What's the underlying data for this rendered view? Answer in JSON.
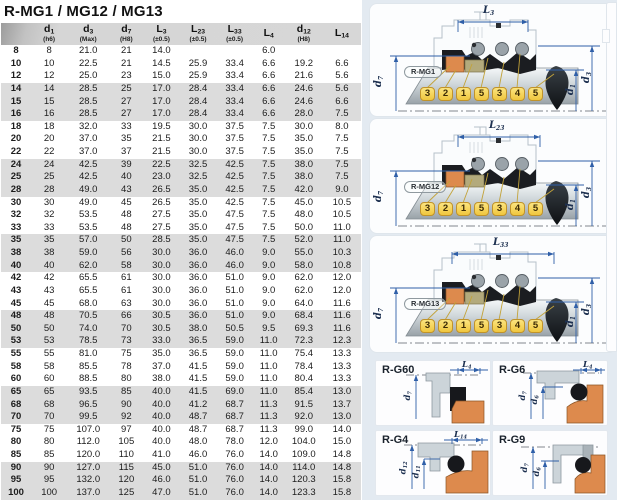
{
  "title": "R-MG1 / MG12 / MG13",
  "table": {
    "columns": [
      {
        "label": "",
        "sub": ""
      },
      {
        "label": "d1",
        "sub": "(h6)"
      },
      {
        "label": "d3",
        "sub": "(Max)"
      },
      {
        "label": "d7",
        "sub": "(H8)"
      },
      {
        "label": "L3",
        "sub": "(±0.5)"
      },
      {
        "label": "L23",
        "sub": "(±0.5)"
      },
      {
        "label": "L33",
        "sub": "(±0.5)"
      },
      {
        "label": "L4",
        "sub": ""
      },
      {
        "label": "d12",
        "sub": "(H8)"
      },
      {
        "label": "L14",
        "sub": ""
      }
    ],
    "rows": [
      [
        "8",
        "8",
        "21.0",
        "21",
        "14.0",
        "",
        "",
        "6.0",
        "",
        ""
      ],
      [
        "10",
        "10",
        "22.5",
        "21",
        "14.5",
        "25.9",
        "33.4",
        "6.6",
        "19.2",
        "6.6"
      ],
      [
        "12",
        "12",
        "25.0",
        "23",
        "15.0",
        "25.9",
        "33.4",
        "6.6",
        "21.6",
        "5.6"
      ],
      [
        "14",
        "14",
        "28.5",
        "25",
        "17.0",
        "28.4",
        "33.4",
        "6.6",
        "24.6",
        "5.6"
      ],
      [
        "15",
        "15",
        "28.5",
        "27",
        "17.0",
        "28.4",
        "33.4",
        "6.6",
        "24.6",
        "6.6"
      ],
      [
        "16",
        "16",
        "28.5",
        "27",
        "17.0",
        "28.4",
        "33.4",
        "6.6",
        "28.0",
        "7.5"
      ],
      [
        "18",
        "18",
        "32.0",
        "33",
        "19.5",
        "30.0",
        "37.5",
        "7.5",
        "30.0",
        "8.0"
      ],
      [
        "20",
        "20",
        "37.0",
        "35",
        "21.5",
        "30.0",
        "37.5",
        "7.5",
        "35.0",
        "7.5"
      ],
      [
        "22",
        "22",
        "37.0",
        "37",
        "21.5",
        "30.0",
        "37.5",
        "7.5",
        "35.0",
        "7.5"
      ],
      [
        "24",
        "24",
        "42.5",
        "39",
        "22.5",
        "32.5",
        "42.5",
        "7.5",
        "38.0",
        "7.5"
      ],
      [
        "25",
        "25",
        "42.5",
        "40",
        "23.0",
        "32.5",
        "42.5",
        "7.5",
        "38.0",
        "7.5"
      ],
      [
        "28",
        "28",
        "49.0",
        "43",
        "26.5",
        "35.0",
        "42.5",
        "7.5",
        "42.0",
        "9.0"
      ],
      [
        "30",
        "30",
        "49.0",
        "45",
        "26.5",
        "35.0",
        "42.5",
        "7.5",
        "45.0",
        "10.5"
      ],
      [
        "32",
        "32",
        "53.5",
        "48",
        "27.5",
        "35.0",
        "47.5",
        "7.5",
        "48.0",
        "10.5"
      ],
      [
        "33",
        "33",
        "53.5",
        "48",
        "27.5",
        "35.0",
        "47.5",
        "7.5",
        "50.0",
        "11.0"
      ],
      [
        "35",
        "35",
        "57.0",
        "50",
        "28.5",
        "35.0",
        "47.5",
        "7.5",
        "52.0",
        "11.0"
      ],
      [
        "38",
        "38",
        "59.0",
        "56",
        "30.0",
        "36.0",
        "46.0",
        "9.0",
        "55.0",
        "10.3"
      ],
      [
        "40",
        "40",
        "62.0",
        "58",
        "30.0",
        "36.0",
        "46.0",
        "9.0",
        "58.0",
        "10.8"
      ],
      [
        "42",
        "42",
        "65.5",
        "61",
        "30.0",
        "36.0",
        "51.0",
        "9.0",
        "62.0",
        "12.0"
      ],
      [
        "43",
        "43",
        "65.5",
        "61",
        "30.0",
        "36.0",
        "51.0",
        "9.0",
        "62.0",
        "12.0"
      ],
      [
        "45",
        "45",
        "68.0",
        "63",
        "30.0",
        "36.0",
        "51.0",
        "9.0",
        "64.0",
        "11.6"
      ],
      [
        "48",
        "48",
        "70.5",
        "66",
        "30.5",
        "36.0",
        "51.0",
        "9.0",
        "68.4",
        "11.6"
      ],
      [
        "50",
        "50",
        "74.0",
        "70",
        "30.5",
        "38.0",
        "50.5",
        "9.5",
        "69.3",
        "11.6"
      ],
      [
        "53",
        "53",
        "78.5",
        "73",
        "33.0",
        "36.5",
        "59.0",
        "11.0",
        "72.3",
        "12.3"
      ],
      [
        "55",
        "55",
        "81.0",
        "75",
        "35.0",
        "36.5",
        "59.0",
        "11.0",
        "75.4",
        "13.3"
      ],
      [
        "58",
        "58",
        "85.5",
        "78",
        "37.0",
        "41.5",
        "59.0",
        "11.0",
        "78.4",
        "13.3"
      ],
      [
        "60",
        "60",
        "88.5",
        "80",
        "38.0",
        "41.5",
        "59.0",
        "11.0",
        "80.4",
        "13.3"
      ],
      [
        "65",
        "65",
        "93.5",
        "85",
        "40.0",
        "41.5",
        "69.0",
        "11.0",
        "85.4",
        "13.0"
      ],
      [
        "68",
        "68",
        "96.5",
        "90",
        "40.0",
        "41.2",
        "68.7",
        "11.3",
        "91.5",
        "13.7"
      ],
      [
        "70",
        "70",
        "99.5",
        "92",
        "40.0",
        "48.7",
        "68.7",
        "11.3",
        "92.0",
        "13.0"
      ],
      [
        "75",
        "75",
        "107.0",
        "97",
        "40.0",
        "48.7",
        "68.7",
        "11.3",
        "99.0",
        "14.0"
      ],
      [
        "80",
        "80",
        "112.0",
        "105",
        "40.0",
        "48.0",
        "78.0",
        "12.0",
        "104.0",
        "15.0"
      ],
      [
        "85",
        "85",
        "120.0",
        "110",
        "41.0",
        "46.0",
        "76.0",
        "14.0",
        "109.0",
        "14.8"
      ],
      [
        "90",
        "90",
        "127.0",
        "115",
        "45.0",
        "51.0",
        "76.0",
        "14.0",
        "114.0",
        "14.8"
      ],
      [
        "95",
        "95",
        "132.0",
        "120",
        "46.0",
        "51.0",
        "76.0",
        "14.0",
        "120.3",
        "15.8"
      ],
      [
        "100",
        "100",
        "137.0",
        "125",
        "47.0",
        "51.0",
        "76.0",
        "14.0",
        "123.3",
        "15.8"
      ]
    ]
  },
  "diagrams": [
    {
      "id": "R-MG1",
      "dim_top": "L3",
      "dim_left": "d7",
      "dim_right_inner": "d1",
      "dim_right_outer": "d3",
      "callouts": [
        "3",
        "2",
        "1",
        "5",
        "3",
        "4",
        "5"
      ]
    },
    {
      "id": "R-MG12",
      "dim_top": "L23",
      "dim_left": "d7",
      "dim_right_inner": "d1",
      "dim_right_outer": "d3",
      "callouts": [
        "3",
        "2",
        "1",
        "5",
        "3",
        "4",
        "5"
      ]
    },
    {
      "id": "R-MG13",
      "dim_top": "L33",
      "dim_left": "d7",
      "dim_right_inner": "d1",
      "dim_right_outer": "d3",
      "callouts": [
        "3",
        "2",
        "1",
        "5",
        "3",
        "4",
        "5"
      ]
    }
  ],
  "detail_panels": [
    {
      "id": "R-G60",
      "dim_top": "L4",
      "dims_left": [
        "d7"
      ]
    },
    {
      "id": "R-G6",
      "dim_top": "L4",
      "dims_left": [
        "d7",
        "d6"
      ]
    },
    {
      "id": "R-G4",
      "dim_top": "L14",
      "dims_left": [
        "d12",
        "d11"
      ]
    },
    {
      "id": "R-G9",
      "dim_top": "",
      "dims_left": [
        "d7",
        "d6"
      ]
    }
  ],
  "colors": {
    "accent_orange": "#dd8a4d",
    "chip_yellow": "#f0c63e",
    "chip_border": "#c0932a",
    "dim_blue": "#2f5fa8",
    "panel_blue_bg": "#e3eaf1",
    "metal_gray": "#aeb6bc",
    "rubber_black": "#1b1d21",
    "olive": "#b3aa7c",
    "stripe_gray": "#dcdcdc",
    "header_gray": "#d6d6d6"
  }
}
